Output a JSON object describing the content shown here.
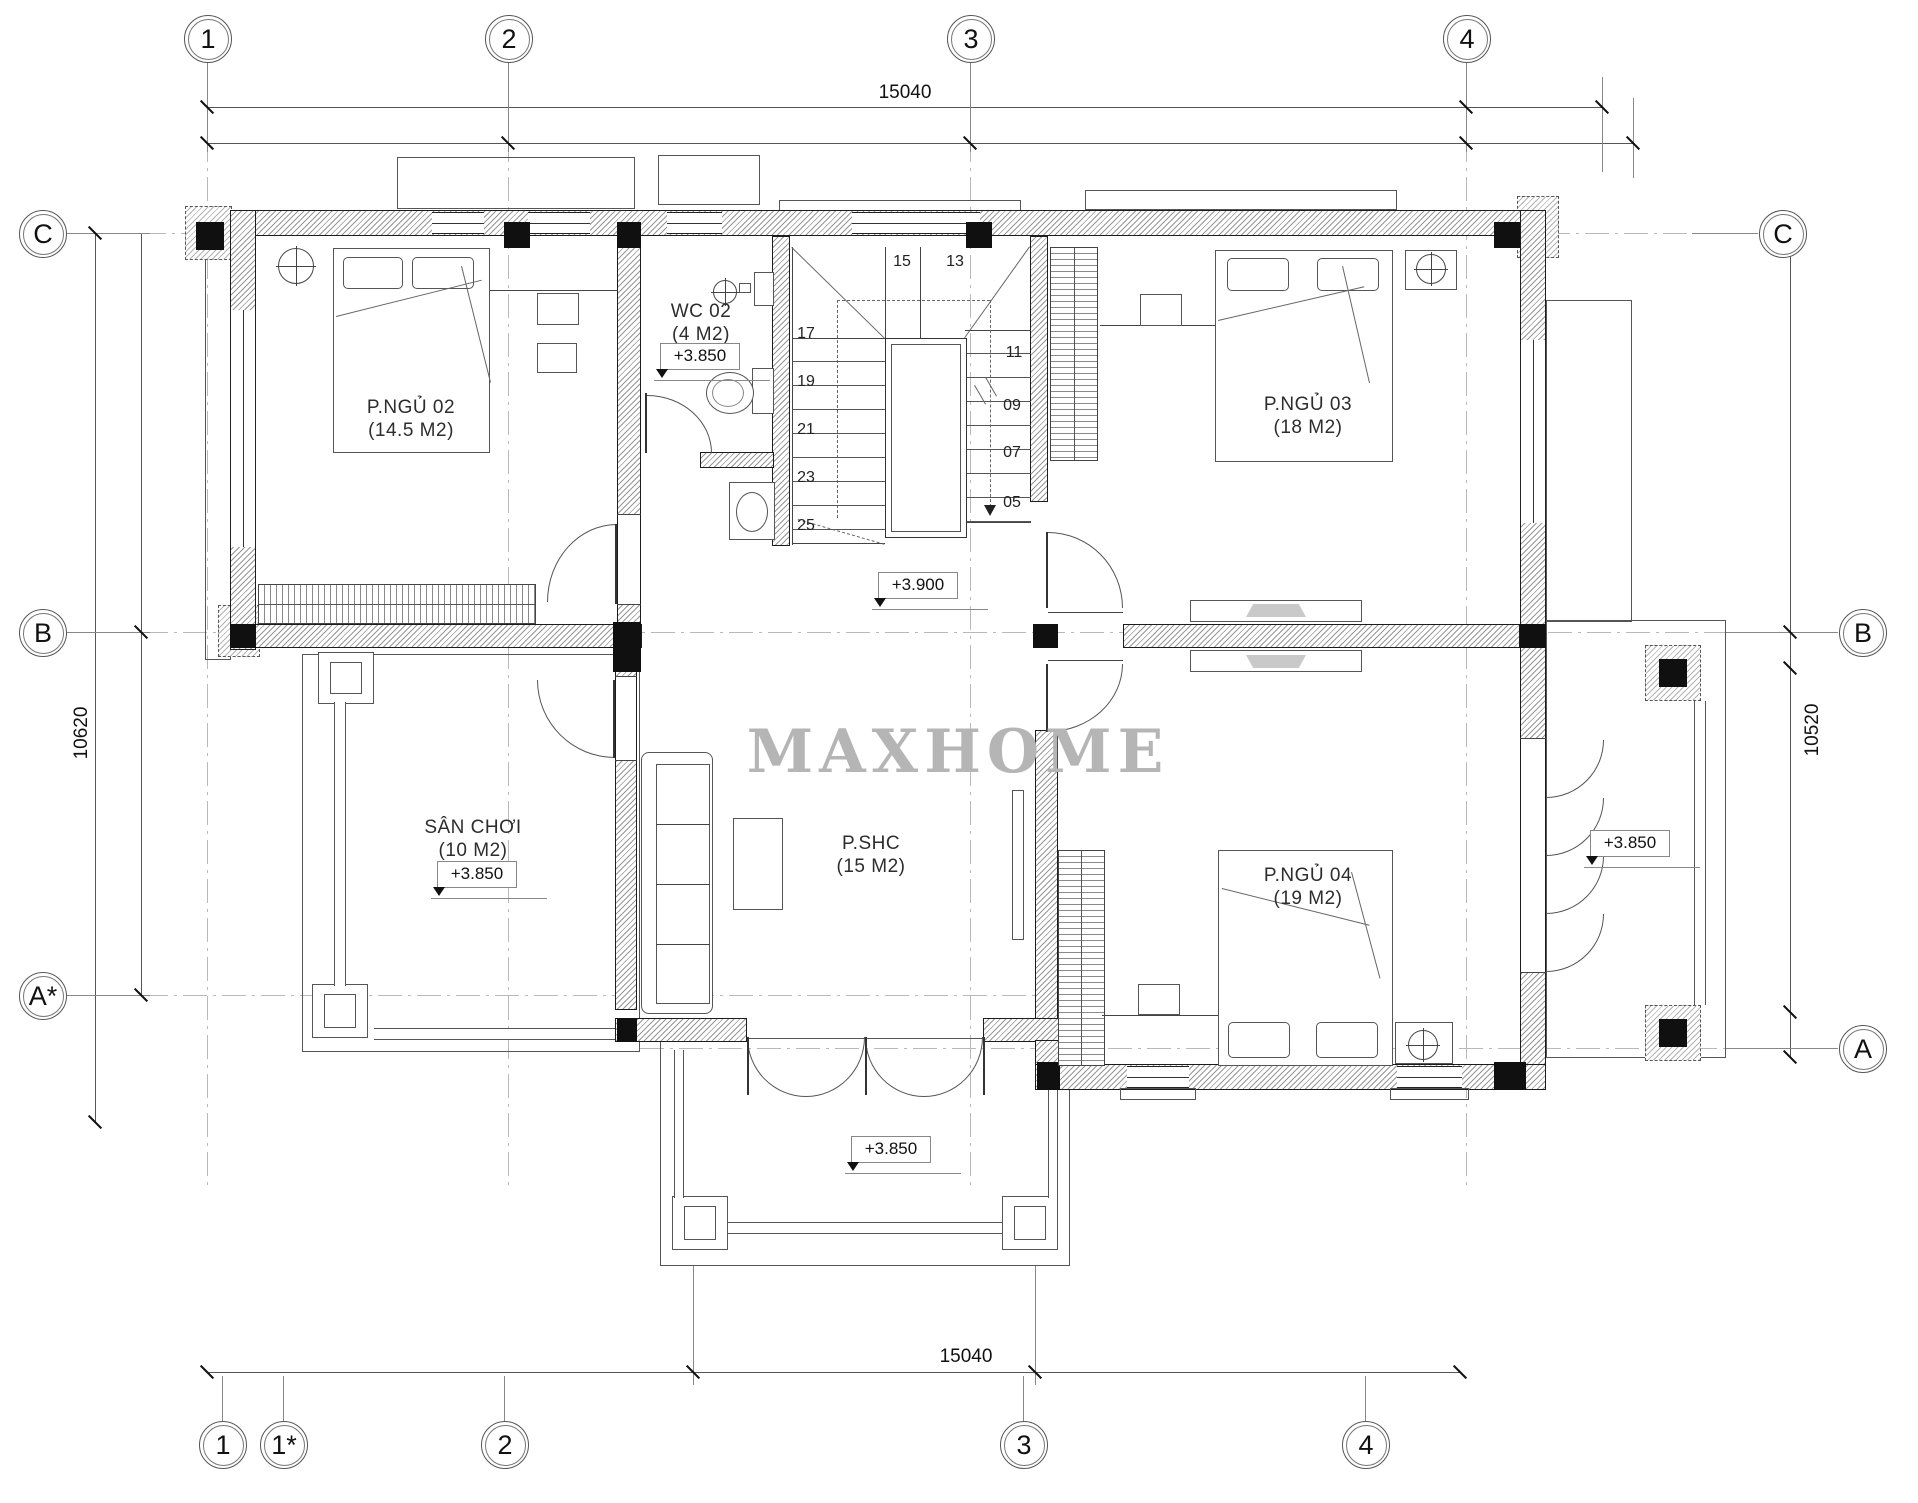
{
  "watermark": "MAXHOME",
  "grid_bubbles": {
    "top": [
      "1",
      "2",
      "3",
      "4"
    ],
    "bottom": [
      "1",
      "1*",
      "2",
      "3",
      "4"
    ],
    "left": [
      "C",
      "B",
      "A*"
    ],
    "right": [
      "C",
      "B",
      "A"
    ]
  },
  "dimensions": {
    "top": "15040",
    "bottom": "15040",
    "left": "10620",
    "right": "10520"
  },
  "rooms": {
    "ngu02": {
      "name": "P.NGỦ 02",
      "area": "(14.5 M2)"
    },
    "wc02": {
      "name": "WC 02",
      "area": "(4 M2)",
      "level": "+3.850"
    },
    "ngu03": {
      "name": "P.NGỦ 03",
      "area": "(18 M2)"
    },
    "san_choi": {
      "name": "SÂN CHƠI",
      "area": "(10 M2)",
      "level": "+3.850"
    },
    "pshc": {
      "name": "P.SHC",
      "area": "(15 M2)"
    },
    "ngu04": {
      "name": "P.NGỦ 04",
      "area": "(19 M2)"
    }
  },
  "levels": {
    "hall": "+3.900",
    "balcony_bottom": "+3.850",
    "balcony_right": "+3.850"
  },
  "stairs": {
    "winder": [
      "15",
      "13"
    ],
    "left_flight": [
      "17",
      "19",
      "21",
      "23",
      "25"
    ],
    "right_flight": [
      "11",
      "09",
      "07",
      "05"
    ]
  }
}
